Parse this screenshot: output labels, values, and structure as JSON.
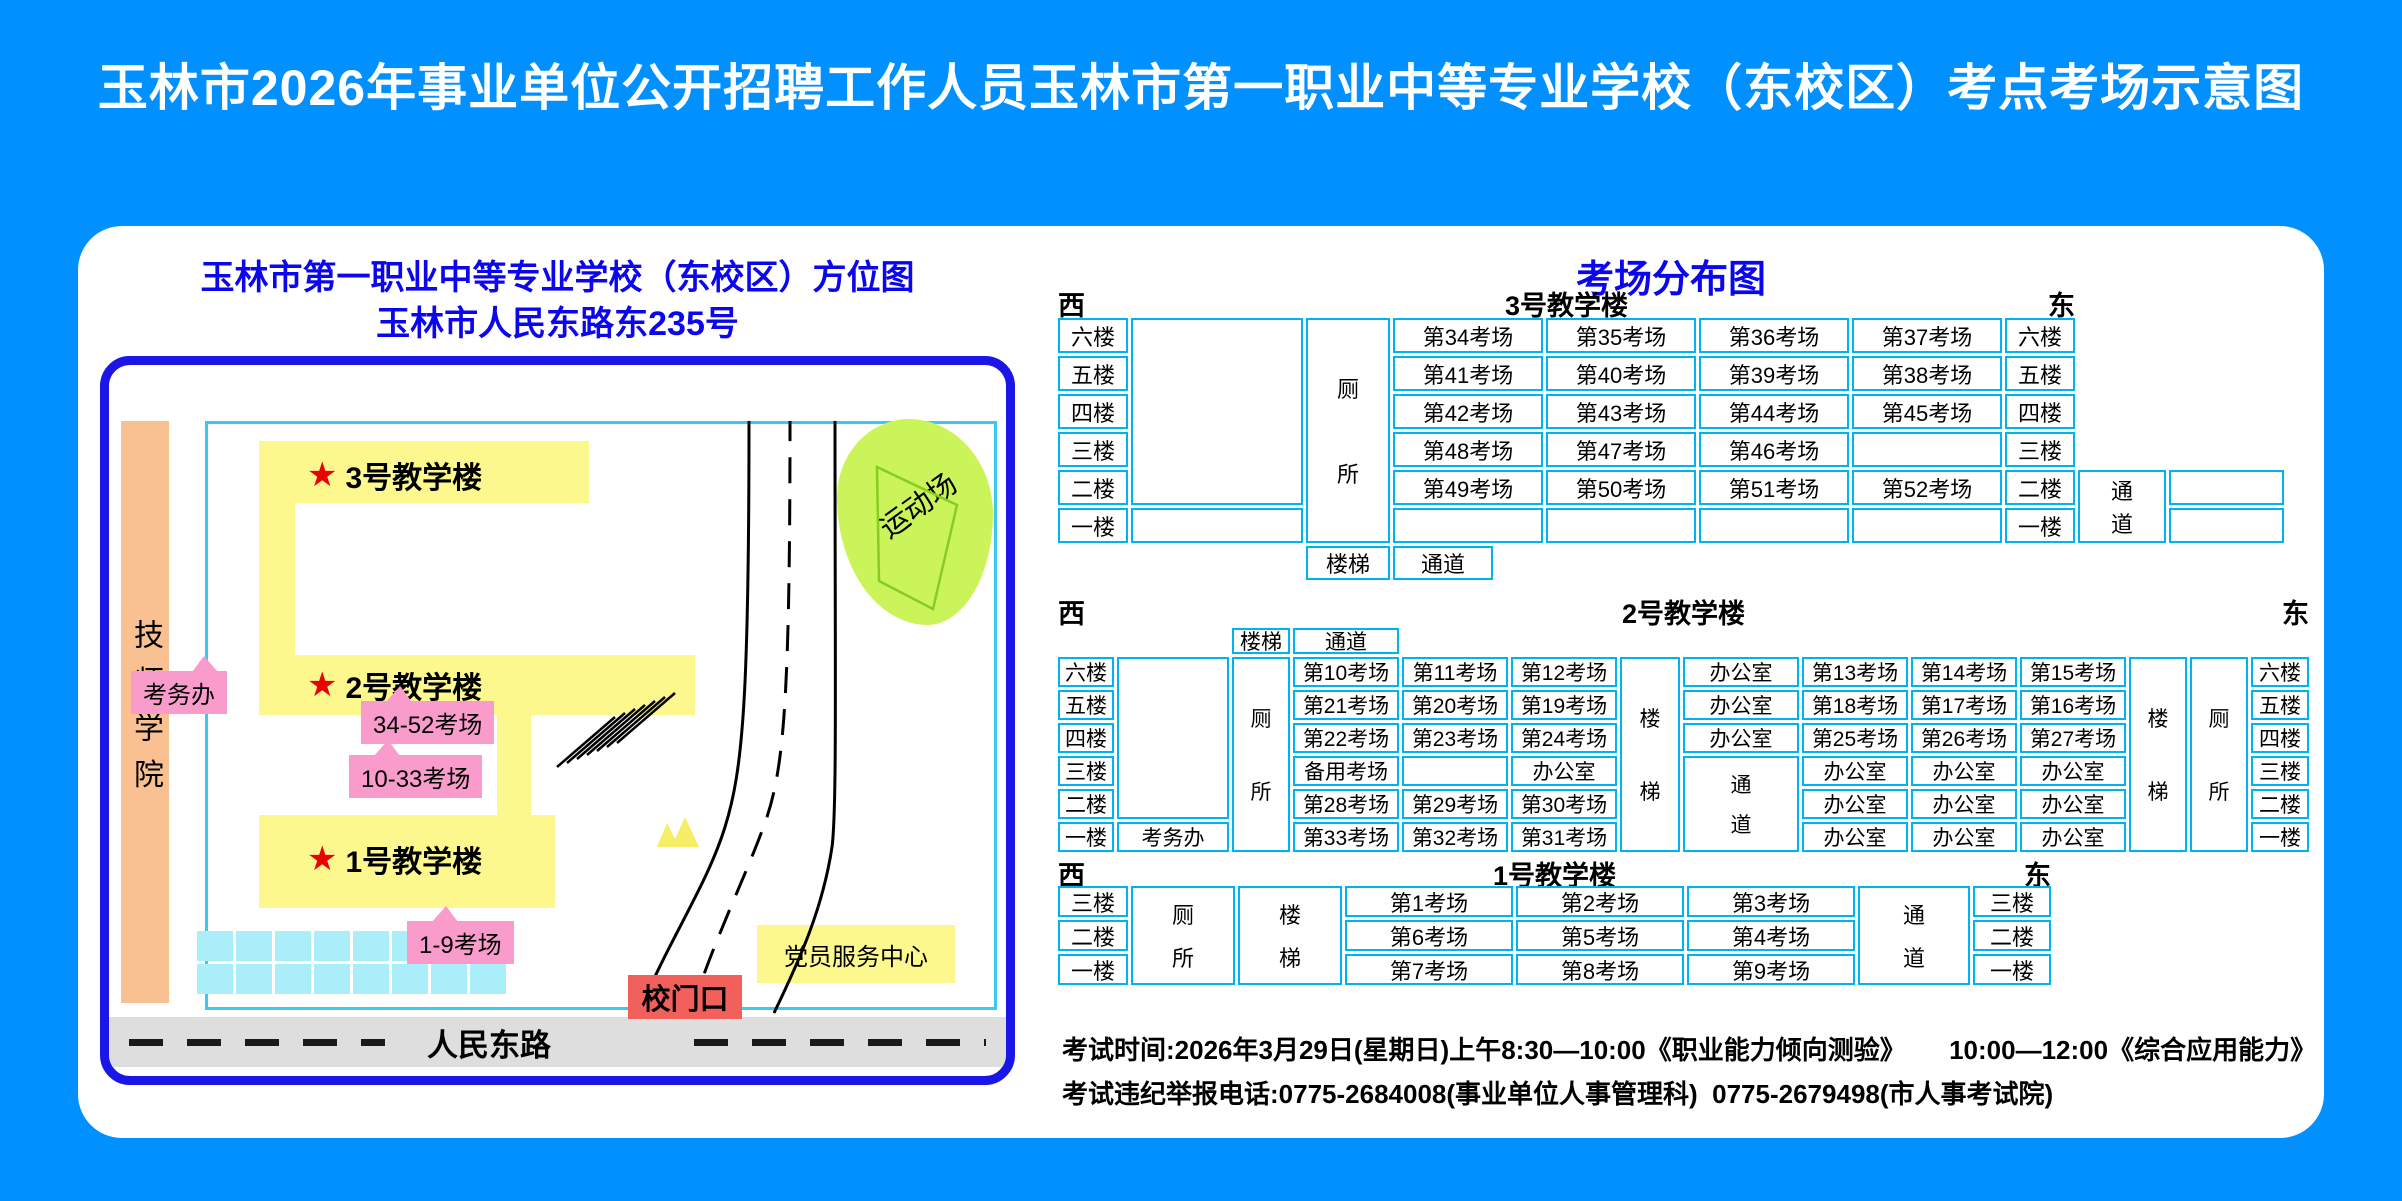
{
  "title": "玉林市2026年事业单位公开招聘工作人员玉林市第一职业中等专业学校（东校区）考点考场示意图",
  "map": {
    "title_line1": "玉林市第一职业中等专业学校（东校区）方位图",
    "title_line2": "玉林市人民东路东235号",
    "neighbor": "技师学院",
    "sports_field": "运动场",
    "b3_star": "★",
    "b3_name": "3号教学楼",
    "b3_tag": "34-52考场",
    "b2_star": "★",
    "b2_name": "2号教学楼",
    "b2_tag": "10-33考场",
    "b1_star": "★",
    "b1_name": "1号教学楼",
    "b1_tag": "1-9考场",
    "office_tag": "考务办",
    "gate": "校门口",
    "party_center": "党员服务中心",
    "road": "人民东路"
  },
  "dist": {
    "title": "考场分布图",
    "b3": {
      "west": "西",
      "east": "东",
      "name": "3号教学楼",
      "floors": [
        "六楼",
        "五楼",
        "四楼",
        "三楼",
        "二楼",
        "一楼"
      ],
      "toilet": [
        "厕",
        "所"
      ],
      "side_passage": [
        "通",
        "道"
      ],
      "stairs": "楼梯",
      "passage": "通道",
      "rows": [
        [
          "第34考场",
          "第35考场",
          "第36考场",
          "第37考场"
        ],
        [
          "第41考场",
          "第40考场",
          "第39考场",
          "第38考场"
        ],
        [
          "第42考场",
          "第43考场",
          "第44考场",
          "第45考场"
        ],
        [
          "第48考场",
          "第47考场",
          "第46考场",
          ""
        ],
        [
          "第49考场",
          "第50考场",
          "第51考场",
          "第52考场"
        ],
        [
          "",
          "",
          "",
          ""
        ]
      ]
    },
    "b2": {
      "west": "西",
      "east": "东",
      "name": "2号教学楼",
      "stairs_top": "楼梯",
      "passage_top": "通道",
      "floors": [
        "六楼",
        "五楼",
        "四楼",
        "三楼",
        "二楼",
        "一楼"
      ],
      "office": "考务办",
      "toilet_left": [
        "厕",
        "所"
      ],
      "stairs_mid": [
        "楼",
        "梯"
      ],
      "passage_mid": [
        "通",
        "道"
      ],
      "stairs_right": [
        "楼",
        "梯"
      ],
      "toilet_right": [
        "厕",
        "所"
      ],
      "left_rows": [
        [
          "第10考场",
          "第11考场",
          "第12考场"
        ],
        [
          "第21考场",
          "第20考场",
          "第19考场"
        ],
        [
          "第22考场",
          "第23考场",
          "第24考场"
        ],
        [
          "备用考场",
          "",
          "办公室"
        ],
        [
          "第28考场",
          "第29考场",
          "第30考场"
        ],
        [
          "第33考场",
          "第32考场",
          "第31考场"
        ]
      ],
      "mid_col": [
        "办公室",
        "办公室",
        "办公室"
      ],
      "right_rows": [
        [
          "第13考场",
          "第14考场",
          "第15考场"
        ],
        [
          "第18考场",
          "第17考场",
          "第16考场"
        ],
        [
          "第25考场",
          "第26考场",
          "第27考场"
        ],
        [
          "办公室",
          "办公室",
          "办公室"
        ],
        [
          "办公室",
          "办公室",
          "办公室"
        ],
        [
          "办公室",
          "办公室",
          "办公室"
        ]
      ]
    },
    "b1": {
      "west": "西",
      "east": "东",
      "name": "1号教学楼",
      "floors": [
        "三楼",
        "二楼",
        "一楼"
      ],
      "toilet": [
        "厕",
        "所"
      ],
      "stairs": [
        "楼",
        "梯"
      ],
      "passage": [
        "通",
        "道"
      ],
      "rows": [
        [
          "第1考场",
          "第2考场",
          "第3考场"
        ],
        [
          "第6考场",
          "第5考场",
          "第4考场"
        ],
        [
          "第7考场",
          "第8考场",
          "第9考场"
        ]
      ]
    }
  },
  "footer": {
    "line1": "考试时间:2026年3月29日(星期日)上午8:30—10:00《职业能力倾向测验》      10:00—12:00《综合应用能力》",
    "line2": "考试违纪举报电话:0775-2684008(事业单位人事管理科)  0775-2679498(市人事考试院)"
  }
}
